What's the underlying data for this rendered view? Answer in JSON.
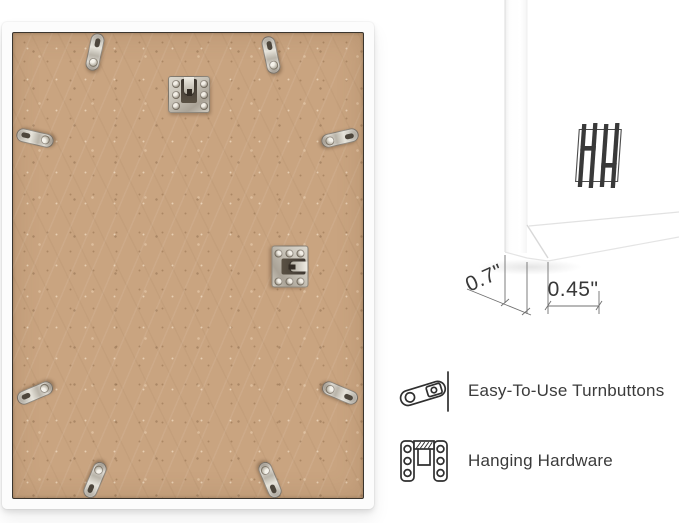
{
  "dimensions": {
    "frame_depth": "0.7\"",
    "frame_face_width": "0.45\""
  },
  "features": {
    "items": [
      {
        "icon": "turnbutton-icon",
        "label": "Easy-To-Use Turnbuttons"
      },
      {
        "icon": "hanging-hardware-icon",
        "label": "Hanging Hardware"
      }
    ]
  },
  "logo": {
    "name": "hh-monogram"
  },
  "hardware": {
    "turnbutton_count": 8,
    "hanging_plate_count": 2
  },
  "colors": {
    "background": "#ffffff",
    "mdf_backing": "#c9a480",
    "frame": "#fcfcfc",
    "metal": "#c8c3b8",
    "text": "#3b3b3b",
    "dimension_lines": "#707070",
    "icon_stroke": "#2f2f2f",
    "logo": "#393939"
  }
}
